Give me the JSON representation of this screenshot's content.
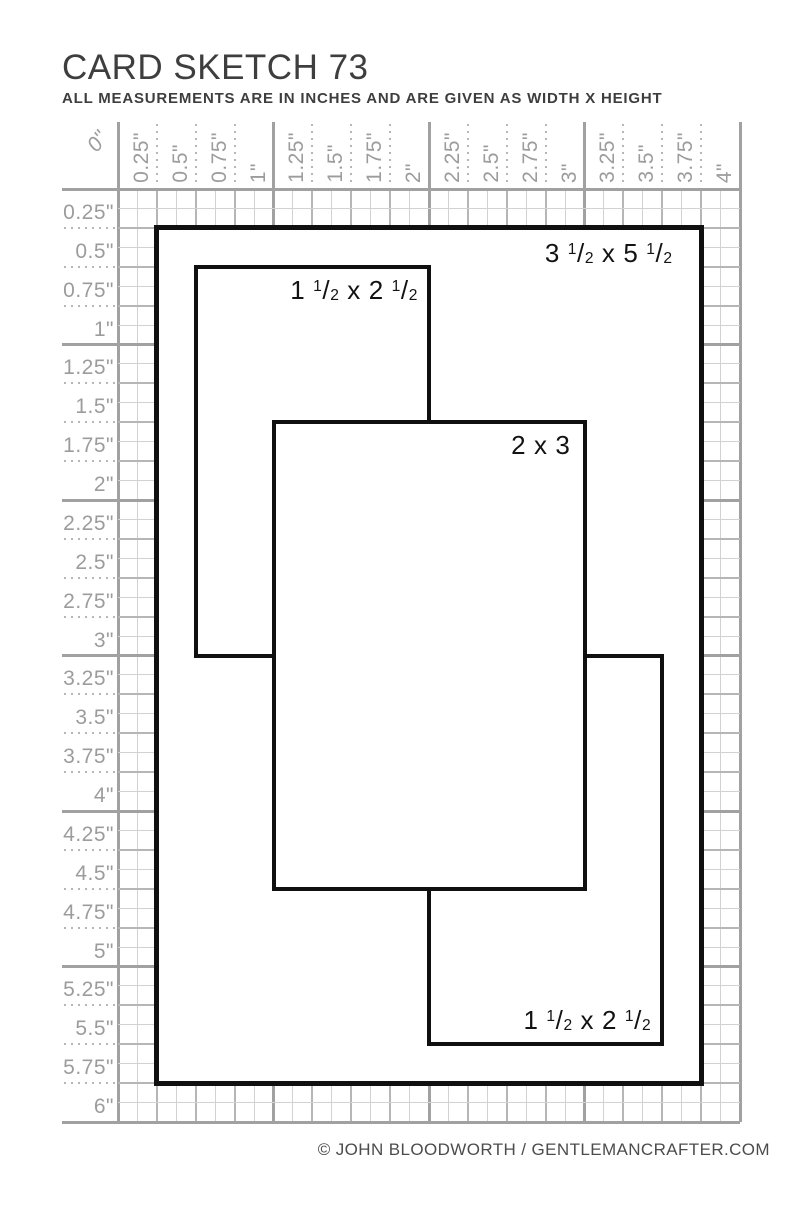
{
  "header": {
    "title": "CARD SKETCH 73",
    "subtitle": "ALL MEASUREMENTS ARE IN INCHES AND ARE GIVEN AS WIDTH X HEIGHT"
  },
  "footer": {
    "credit": "© JOHN BLOODWORTH / GENTLEMANCRAFTER.COM"
  },
  "rulers": {
    "unit": "inches",
    "top_labels": [
      "0\"",
      "0.25\"",
      "0.5\"",
      "0.75\"",
      "1\"",
      "1.25\"",
      "1.5\"",
      "1.75\"",
      "2\"",
      "2.25\"",
      "2.5\"",
      "2.75\"",
      "3\"",
      "3.25\"",
      "3.5\"",
      "3.75\"",
      "4\""
    ],
    "left_labels": [
      "0.25\"",
      "0.5\"",
      "0.75\"",
      "1\"",
      "1.25\"",
      "1.5\"",
      "1.75\"",
      "2\"",
      "2.25\"",
      "2.5\"",
      "2.75\"",
      "3\"",
      "3.25\"",
      "3.5\"",
      "3.75\"",
      "4\"",
      "4.25\"",
      "4.5\"",
      "4.75\"",
      "5\"",
      "5.25\"",
      "5.5\"",
      "5.75\"",
      "6\""
    ]
  },
  "grid": {
    "width_inches": 4,
    "height_inches": 6,
    "minor_step_inches": 0.125
  },
  "shapes": [
    {
      "name": "card-base",
      "label": "3 1/2 x 5 1/2",
      "x_in": 0.25,
      "y_in": 0.25,
      "w_in": 3.5,
      "h_in": 5.5,
      "label_corner": "top-right"
    },
    {
      "name": "panel-top-left",
      "label": "1 1/2 x 2 1/2",
      "x_in": 0.5,
      "y_in": 0.5,
      "w_in": 1.5,
      "h_in": 2.5,
      "label_corner": "top-right"
    },
    {
      "name": "panel-bottom-right",
      "label": "1 1/2 x 2 1/2",
      "x_in": 2.0,
      "y_in": 3.0,
      "w_in": 1.5,
      "h_in": 2.5,
      "label_corner": "bottom-right"
    },
    {
      "name": "panel-center",
      "label": "2 x 3",
      "x_in": 1.0,
      "y_in": 1.5,
      "w_in": 2.0,
      "h_in": 3.0,
      "label_corner": "top-right"
    }
  ],
  "colors": {
    "shape_outline": "#101010",
    "label_text": "#131313",
    "grid_inch_line": "#a1a1a1",
    "grid_quarter_line": "#b6b6b6",
    "grid_minor_line": "#d2d2d2",
    "ruler_label": "#9c9c9c",
    "heading_text": "#3e3e3e",
    "credit_text": "#4c4c4c"
  }
}
